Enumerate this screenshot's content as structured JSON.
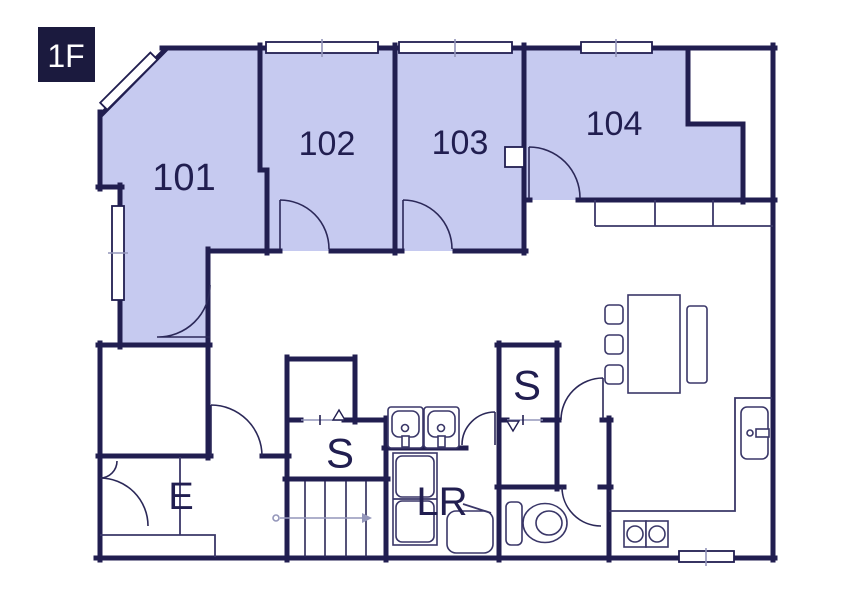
{
  "floor": {
    "badge": "1F"
  },
  "rooms": [
    {
      "id": "101",
      "label": "101"
    },
    {
      "id": "102",
      "label": "102"
    },
    {
      "id": "103",
      "label": "103"
    },
    {
      "id": "104",
      "label": "104"
    }
  ],
  "areas": {
    "storage_center": "S",
    "storage_right": "S",
    "entrance": "E",
    "laundry": "LR"
  },
  "colors": {
    "wall": "#211e50",
    "room_fill": "#c6caf0",
    "background": "#ffffff",
    "badge_bg": "#1b1a3e",
    "badge_text": "#ffffff",
    "furniture_line": "#3a3768",
    "light_line": "#9496ba"
  }
}
